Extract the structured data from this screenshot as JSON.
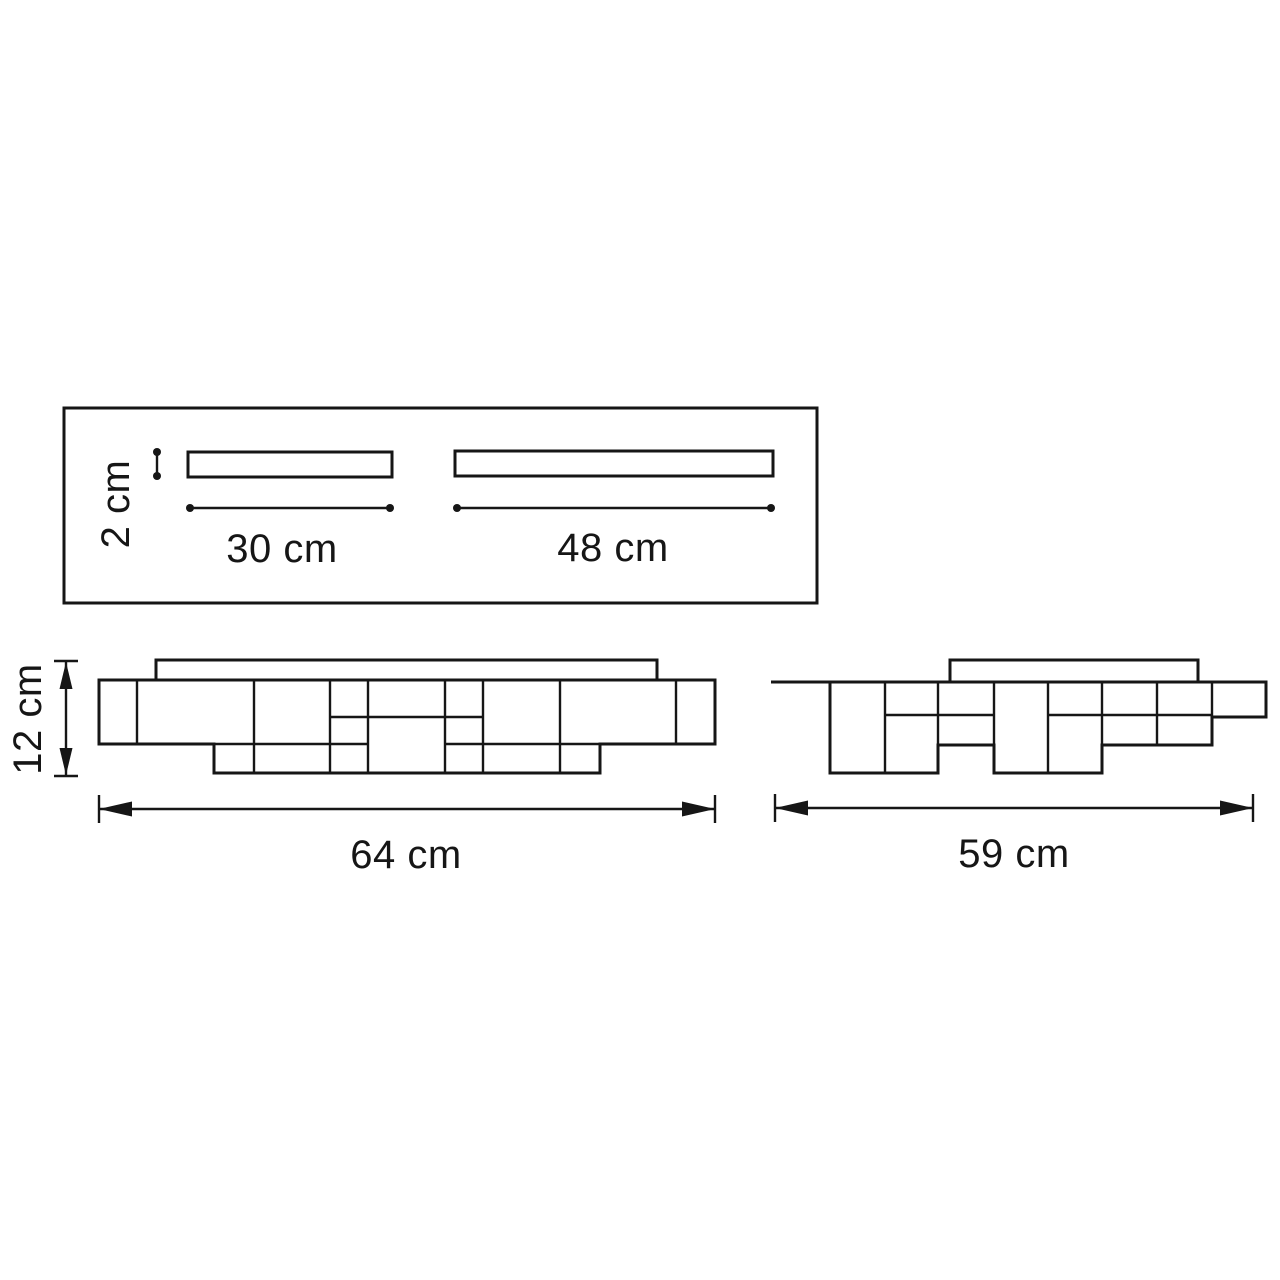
{
  "canvas": {
    "background_color": "#ffffff",
    "line_color": "#161616",
    "drawing_type": "technical dimension drawing of ceiling light fixture"
  },
  "views": {
    "top_view": {
      "name": "mounting plate top view",
      "bar_height_label": "2 cm",
      "bar1_length_label": "30 cm",
      "bar2_length_label": "48 cm"
    },
    "front_view": {
      "name": "front elevation",
      "height_label": "12 cm",
      "width_label": "64 cm"
    },
    "side_view": {
      "name": "side elevation",
      "width_label": "59 cm"
    }
  }
}
